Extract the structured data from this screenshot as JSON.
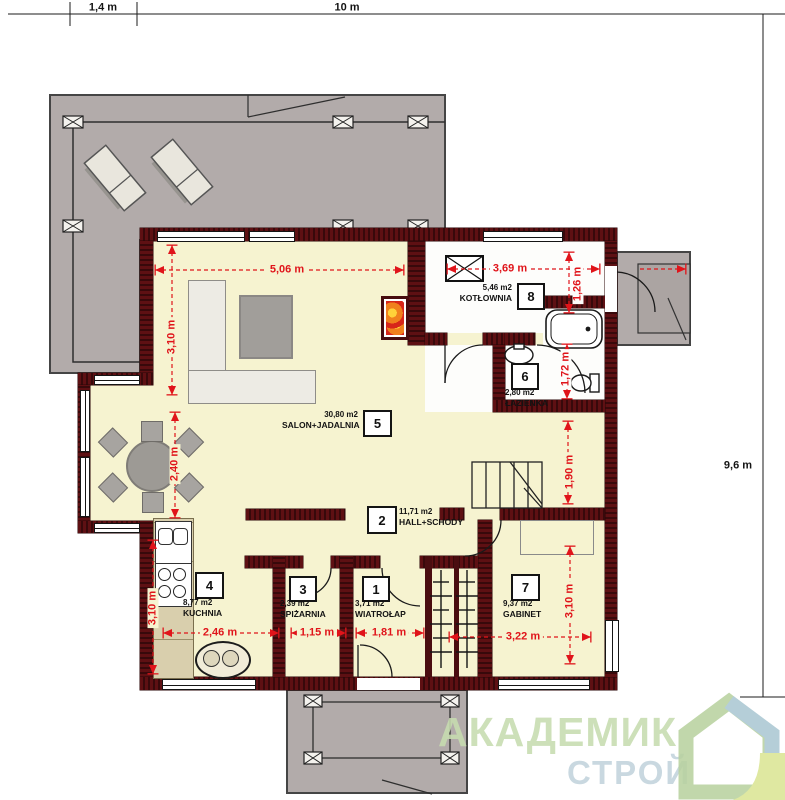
{
  "outer_dimensions": {
    "left_offset": "1,4 m",
    "total_width": "10 m",
    "total_height": "9,6 m"
  },
  "rooms": [
    {
      "number": "1",
      "area": "3,71 m2",
      "name": "WIATROŁAP"
    },
    {
      "number": "2",
      "area": "11,71 m2",
      "name": "HALL+SCHODY"
    },
    {
      "number": "3",
      "area": "2,39 m2",
      "name": "SPIŻARNIA"
    },
    {
      "number": "4",
      "area": "8,77 m2",
      "name": "KUCHNIA"
    },
    {
      "number": "5",
      "area": "30,80 m2",
      "name": "SALON+JADALNIA"
    },
    {
      "number": "6",
      "area": "2,80 m2",
      "name": "ŁAZIENKA"
    },
    {
      "number": "7",
      "area": "9,37 m2",
      "name": "GABINET"
    },
    {
      "number": "8",
      "area": "5,46 m2",
      "name": "KOTŁOWNIA"
    }
  ],
  "interior_dimensions": {
    "salon_width": "5,06 m",
    "salon_height": "3,10 m",
    "dining_depth": "2,40 m",
    "kitchen_height": "3,10 m",
    "kitchen_width": "2,46 m",
    "pantry_width": "1,15 m",
    "vestibule_width": "1,81 m",
    "boiler_width": "3,69 m",
    "boiler_height": "1,26 m",
    "bath_height": "1,72 m",
    "hall_height": "1,90 m",
    "office_width": "3,22 m",
    "office_height": "3,10 m"
  },
  "watermark": {
    "line1": "АКАДЕМИК",
    "line2": "СТРОЙ"
  },
  "colors": {
    "wall": "#5e1013",
    "wall_hatch": "#38090b",
    "floor": "#f6f3d0",
    "terrace": "#b2abaa",
    "dimension_red": "#e0141a",
    "watermark_green": "#c7dcb0",
    "watermark_blue": "#c2d3dc"
  }
}
